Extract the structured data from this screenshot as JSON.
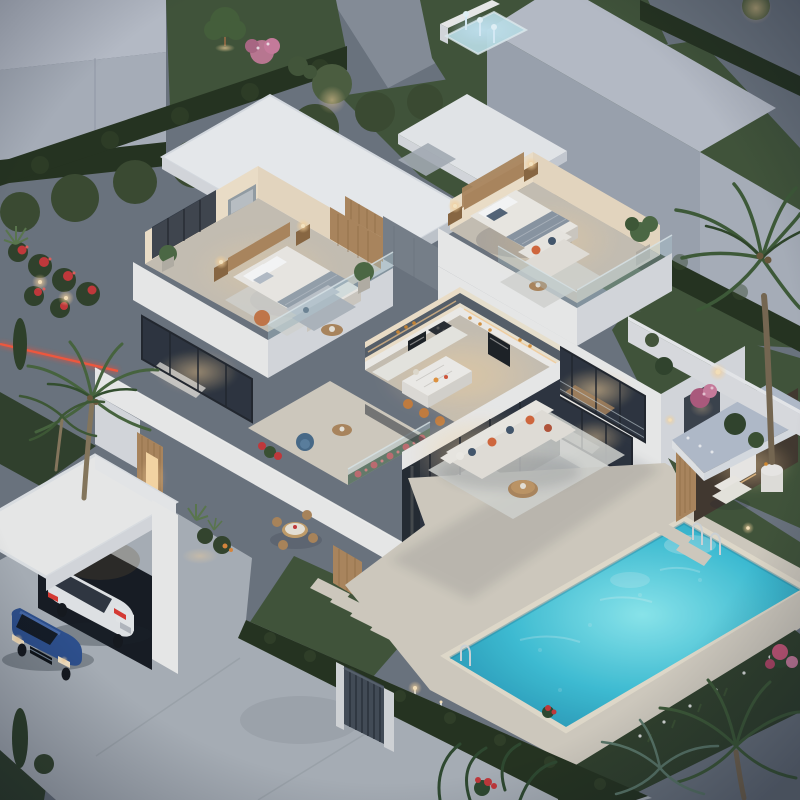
{
  "scene": {
    "description": "Dusk aerial isometric 3D render of a modern white two-storey villa with open cutaway upper-floor bedrooms, warm-lit kitchen and living rooms, roof terraces with glass railings and red flower planters, a garage with a white SUV and a blue sedan, a large turquoise swimming pool with chrome ladders, outdoor lounge sofa with orange and navy cushions, a pool cabana bar, palm trees, clipped hedges, lawns, a neighbouring grey building and a small glowing fountain",
    "time_of_day": "dusk",
    "objects": [
      {
        "name": "neighbor-building-left",
        "label": "Grey neighbouring building"
      },
      {
        "name": "neighbor-building-right",
        "label": "Grey neighbouring building"
      },
      {
        "name": "fountain",
        "label": "Glowing water feature"
      },
      {
        "name": "hedge",
        "label": "Clipped hedge row"
      },
      {
        "name": "villa",
        "label": "Modern white villa"
      },
      {
        "name": "roof-slab",
        "label": "Flat white roof slab"
      },
      {
        "name": "bedroom-left",
        "label": "Open cutaway master bedroom"
      },
      {
        "name": "bedroom-right",
        "label": "Open cutaway second bedroom with terrace"
      },
      {
        "name": "kitchen",
        "label": "Open cutaway kitchen with island and stools"
      },
      {
        "name": "dining-window",
        "label": "Lit dining room window"
      },
      {
        "name": "living-room-glass",
        "label": "Glazed living room"
      },
      {
        "name": "terrace",
        "label": "Balcony terrace with armchair and flower planters"
      },
      {
        "name": "garage",
        "label": "Garage with two cars"
      },
      {
        "name": "car-suv-white",
        "label": "White SUV"
      },
      {
        "name": "car-sedan-blue",
        "label": "Blue sedan"
      },
      {
        "name": "driveway",
        "label": "Concrete driveway"
      },
      {
        "name": "gate",
        "label": "Metal garden gate"
      },
      {
        "name": "pool",
        "label": "Turquoise swimming pool"
      },
      {
        "name": "pool-ladder",
        "label": "Chrome pool ladder"
      },
      {
        "name": "lounge-sofa",
        "label": "Outdoor L-shaped lounge sofa"
      },
      {
        "name": "cabana",
        "label": "Pool cabana bar"
      },
      {
        "name": "palm-tree",
        "label": "Palm tree"
      },
      {
        "name": "flower-bed",
        "label": "Red flower bed"
      },
      {
        "name": "path-light",
        "label": "Warm garden light"
      },
      {
        "name": "led-strip",
        "label": "Red LED road strip"
      }
    ]
  },
  "palette": {
    "lawn_dark": "#31412c",
    "lawn": "#42563a",
    "lawn_light": "#4f6845",
    "hedge": "#26331f",
    "hedge_light": "#3a4c30",
    "road": "#6e7681",
    "road_light": "#8d959e",
    "concrete": "#aeb4bb",
    "deck": "#d7d1c4",
    "house_white": "#f2f2f1",
    "house_lit": "#f6efe4",
    "house_shade": "#dcdfe3",
    "house_dark": "#c6cbd2",
    "neighbor_top": "#bdc2cc",
    "neighbor_face": "#a0a7b3",
    "neighbor_face2": "#aeb4bf",
    "glass": "#2e3540",
    "glass_frame": "#23272e",
    "warm_glow": "#ffd9a0",
    "warm_deep": "#ffb45c",
    "interior_warm": "#f6e7cf",
    "wood": "#b18a5f",
    "wood_dark": "#8e6a42",
    "pool_deep": "#2796b6",
    "pool_mid": "#3fc3da",
    "pool_light": "#8feef4",
    "water_glass": "#bfe3ea",
    "sofa": "#eae6df",
    "sofa_shade": "#d4cfc6",
    "pillow_orange": "#d96a3d",
    "pillow_navy": "#45586e",
    "car_blue": "#2e5191",
    "car_white": "#e9ebed",
    "flower_red": "#c9393b",
    "flower_pink": "#cf7fa0",
    "tile": "#cdc5b8",
    "rug": "#d9dad6",
    "cabana_roof": "#b7c1d0",
    "night_shadow": "#1c2430"
  }
}
